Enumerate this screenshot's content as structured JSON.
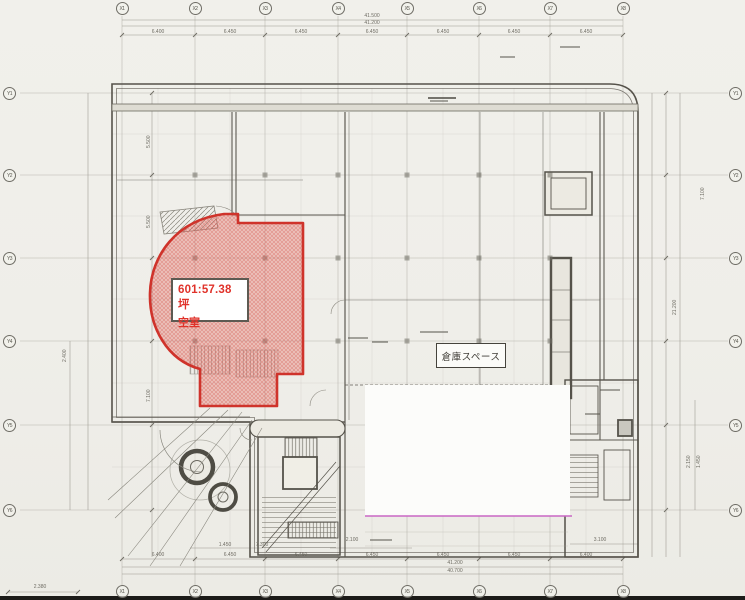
{
  "unit": {
    "area_label": "601:57.38坪",
    "status_label": "空室"
  },
  "warehouse": {
    "label": "倉庫スペース"
  },
  "grid": {
    "top": [
      "X1",
      "X2",
      "X3",
      "X4",
      "X5",
      "X6",
      "X7",
      "X8"
    ],
    "bottom": [
      "X1",
      "X2",
      "X3",
      "X4",
      "X5",
      "X6",
      "X7",
      "X8"
    ],
    "left": [
      "Y1",
      "Y2",
      "Y3",
      "Y4",
      "Y5",
      "Y6"
    ],
    "right": [
      "Y1",
      "Y2",
      "Y3",
      "Y4",
      "Y5",
      "Y6"
    ]
  },
  "dimensions": {
    "top_total_1": "41.500",
    "top_total_2": "41.200",
    "top_segments": [
      "6.400",
      "6.450",
      "6.450",
      "6.450",
      "6.450",
      "6.450",
      "6.450"
    ],
    "bottom_segments": [
      "6.400",
      "6.450",
      "6.450",
      "6.450",
      "6.450",
      "6.450",
      "6.400"
    ],
    "bottom_total_1": "41.200",
    "bottom_total_2": "40.700",
    "bottom_left": "2.380",
    "bottom_extra": [
      "1.450",
      "7.300",
      "2.100",
      "3.100"
    ],
    "left_dims": [
      "5.500",
      "5.500",
      "7.100",
      "2.400"
    ],
    "right_dims": [
      "7.100",
      "2.150",
      "1.450",
      "21.200"
    ]
  },
  "colors": {
    "unit_accent": "#cf332b",
    "unit_fill": "#f3b6b1",
    "highlight_line": "#c967c4",
    "paper": "#efede8"
  }
}
